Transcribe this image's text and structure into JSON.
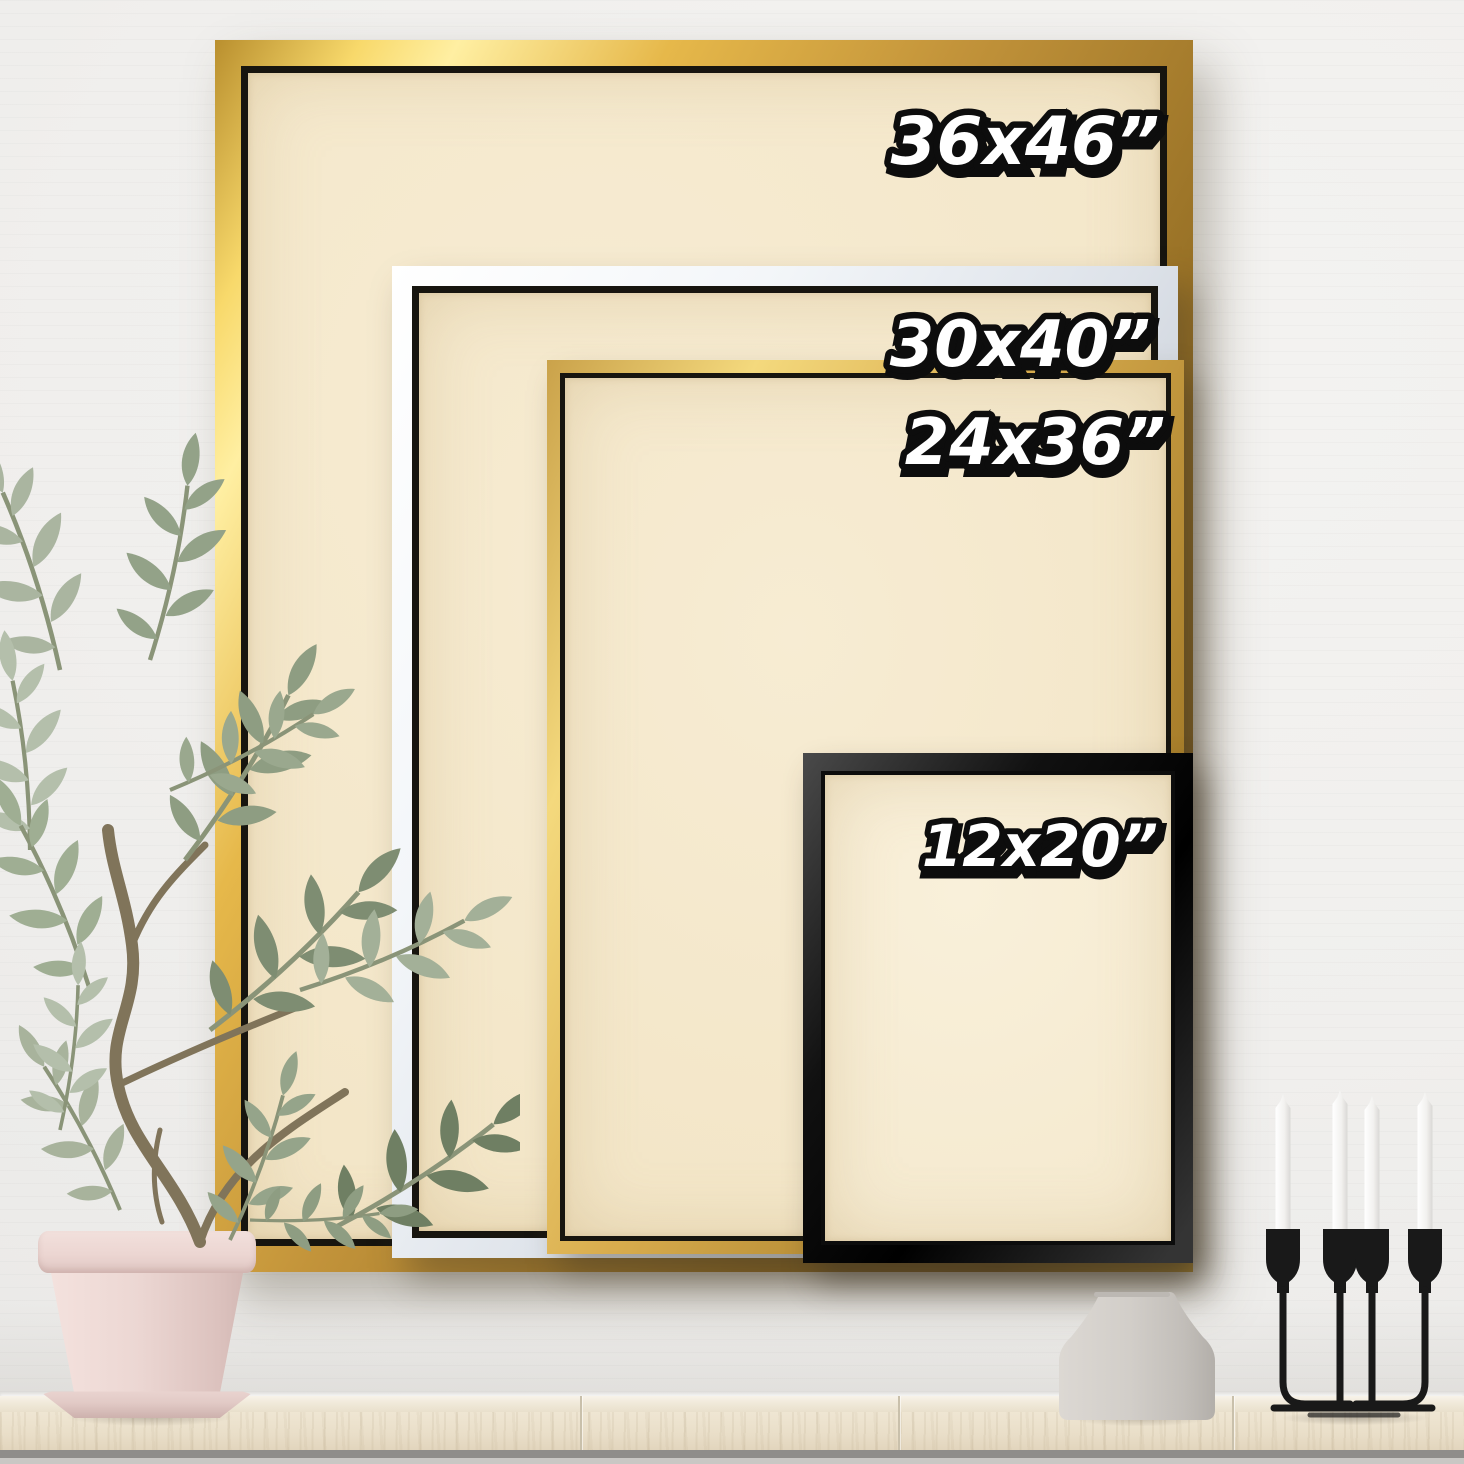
{
  "scene": {
    "description": "Product size-comparison photo: four framed canvases on a white shiplap wall above a light wood shelf",
    "wall_color": "#f0efed",
    "canvas_color": "#f4e8cd",
    "shelf_color": "#ece2cf"
  },
  "frames": [
    {
      "id": "frame-36x46",
      "label": "36x46”",
      "finish": "gold",
      "finish_color": "#cf9f3c"
    },
    {
      "id": "frame-30x40",
      "label": "30x40”",
      "finish": "white",
      "finish_color": "#eef1f4"
    },
    {
      "id": "frame-24x36",
      "label": "24x36”",
      "finish": "gold",
      "finish_color": "#d9ad4e"
    },
    {
      "id": "frame-12x20",
      "label": "12x20”",
      "finish": "black",
      "finish_color": "#161616"
    }
  ],
  "label_style": {
    "fill": "#ffffff",
    "outline": "#0d0d0d"
  },
  "decor": {
    "plant": "potted-olive-tree",
    "plant_leaf_color": "#9aa88e",
    "pot_color": "#e9d4d0",
    "vase": "gray-ceramic-vase",
    "vase_color": "#cdc9c3",
    "candelabra": "black-metal-candelabra",
    "candelabra_color": "#1a1a1a",
    "candle_count": "4",
    "candle_color": "#f4f3f1"
  }
}
